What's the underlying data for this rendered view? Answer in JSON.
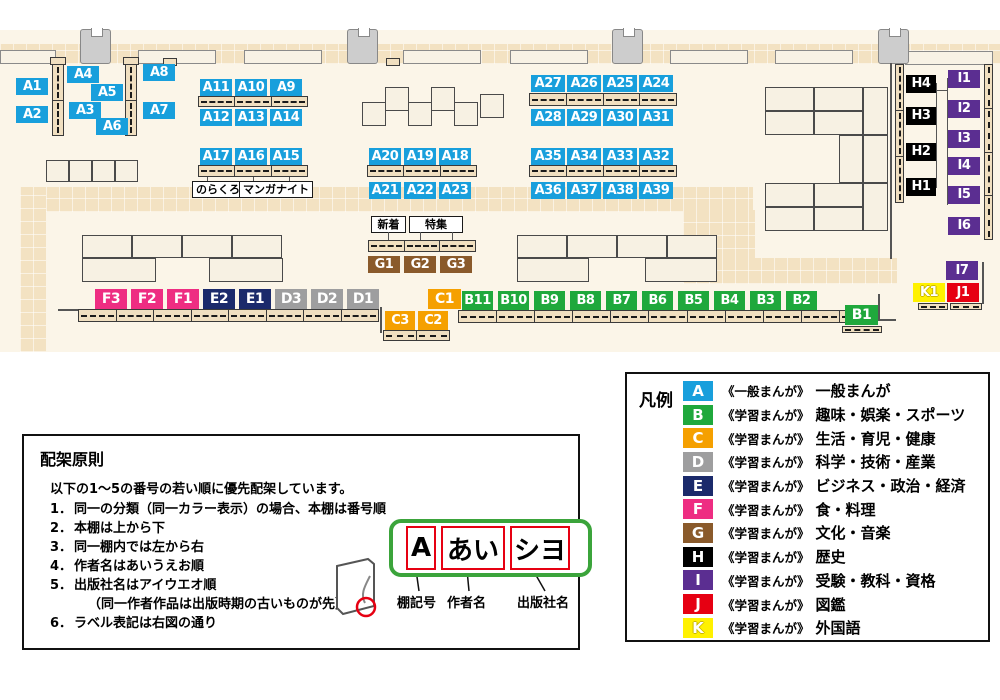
{
  "map": {
    "colors": {
      "A": "#189FDC",
      "B": "#1FA83C",
      "C": "#F5A000",
      "D": "#9E9E9F",
      "E": "#1B2A6B",
      "F": "#EE2D82",
      "G": "#8A5A2B",
      "H": "#000000",
      "I": "#5B2E91",
      "J": "#E60012",
      "K": "#FFF100"
    },
    "groups": {
      "a1": [
        {
          "t": "A1",
          "c": "A"
        }
      ],
      "a2": [
        {
          "t": "A2",
          "c": "A"
        }
      ],
      "a3": [
        {
          "t": "A3",
          "c": "A"
        }
      ],
      "a4": [
        {
          "t": "A4",
          "c": "A"
        }
      ],
      "a5": [
        {
          "t": "A5",
          "c": "A"
        }
      ],
      "a6": [
        {
          "t": "A6",
          "c": "A"
        }
      ],
      "a7": [
        {
          "t": "A7",
          "c": "A"
        }
      ],
      "a8": [
        {
          "t": "A8",
          "c": "A"
        }
      ],
      "row_a9": [
        {
          "t": "A11",
          "c": "A"
        },
        {
          "t": "A10",
          "c": "A"
        },
        {
          "t": "A9",
          "c": "A"
        }
      ],
      "row_a12": [
        {
          "t": "A12",
          "c": "A"
        },
        {
          "t": "A13",
          "c": "A"
        },
        {
          "t": "A14",
          "c": "A"
        }
      ],
      "row_a15": [
        {
          "t": "A17",
          "c": "A"
        },
        {
          "t": "A16",
          "c": "A"
        },
        {
          "t": "A15",
          "c": "A"
        }
      ],
      "row_a18": [
        {
          "t": "A20",
          "c": "A"
        },
        {
          "t": "A19",
          "c": "A"
        },
        {
          "t": "A18",
          "c": "A"
        }
      ],
      "row_a21": [
        {
          "t": "A21",
          "c": "A"
        },
        {
          "t": "A22",
          "c": "A"
        },
        {
          "t": "A23",
          "c": "A"
        }
      ],
      "row_a24": [
        {
          "t": "A27",
          "c": "A"
        },
        {
          "t": "A26",
          "c": "A"
        },
        {
          "t": "A25",
          "c": "A"
        },
        {
          "t": "A24",
          "c": "A"
        }
      ],
      "row_a28": [
        {
          "t": "A28",
          "c": "A"
        },
        {
          "t": "A29",
          "c": "A"
        },
        {
          "t": "A30",
          "c": "A"
        },
        {
          "t": "A31",
          "c": "A"
        }
      ],
      "row_a32": [
        {
          "t": "A35",
          "c": "A"
        },
        {
          "t": "A34",
          "c": "A"
        },
        {
          "t": "A33",
          "c": "A"
        },
        {
          "t": "A32",
          "c": "A"
        }
      ],
      "row_a36": [
        {
          "t": "A36",
          "c": "A"
        },
        {
          "t": "A37",
          "c": "A"
        },
        {
          "t": "A38",
          "c": "A"
        },
        {
          "t": "A39",
          "c": "A"
        }
      ],
      "row_g": [
        {
          "t": "G1",
          "c": "G"
        },
        {
          "t": "G2",
          "c": "G"
        },
        {
          "t": "G3",
          "c": "G"
        }
      ],
      "row_fed": [
        {
          "t": "F3",
          "c": "F"
        },
        {
          "t": "F2",
          "c": "F"
        },
        {
          "t": "F1",
          "c": "F"
        },
        {
          "t": "E2",
          "c": "E"
        },
        {
          "t": "E1",
          "c": "E"
        },
        {
          "t": "D3",
          "c": "D"
        },
        {
          "t": "D2",
          "c": "D"
        },
        {
          "t": "D1",
          "c": "D"
        }
      ],
      "c1": [
        {
          "t": "C1",
          "c": "C"
        }
      ],
      "row_c23": [
        {
          "t": "C3",
          "c": "C"
        },
        {
          "t": "C2",
          "c": "C"
        }
      ],
      "row_b": [
        {
          "t": "B11",
          "c": "B"
        },
        {
          "t": "B10",
          "c": "B"
        },
        {
          "t": "B9",
          "c": "B"
        },
        {
          "t": "B8",
          "c": "B"
        },
        {
          "t": "B7",
          "c": "B"
        },
        {
          "t": "B6",
          "c": "B"
        },
        {
          "t": "B5",
          "c": "B"
        },
        {
          "t": "B4",
          "c": "B"
        },
        {
          "t": "B3",
          "c": "B"
        },
        {
          "t": "B2",
          "c": "B"
        }
      ],
      "b1": [
        {
          "t": "B1",
          "c": "B"
        }
      ],
      "h4": [
        {
          "t": "H4",
          "c": "H"
        }
      ],
      "h3": [
        {
          "t": "H3",
          "c": "H"
        }
      ],
      "h2": [
        {
          "t": "H2",
          "c": "H"
        }
      ],
      "h1": [
        {
          "t": "H1",
          "c": "H"
        }
      ],
      "i1": [
        {
          "t": "I1",
          "c": "I"
        }
      ],
      "i2": [
        {
          "t": "I2",
          "c": "I"
        }
      ],
      "i3": [
        {
          "t": "I3",
          "c": "I"
        }
      ],
      "i4": [
        {
          "t": "I4",
          "c": "I"
        }
      ],
      "i5": [
        {
          "t": "I5",
          "c": "I"
        }
      ],
      "i6": [
        {
          "t": "I6",
          "c": "I"
        }
      ],
      "i7": [
        {
          "t": "I7",
          "c": "I"
        }
      ],
      "k1": [
        {
          "t": "K1",
          "c": "K"
        }
      ],
      "j1": [
        {
          "t": "J1",
          "c": "J"
        }
      ]
    }
  },
  "annotations": {
    "norakuro": "のらくろ",
    "manganight": "マンガナイト",
    "new_arrivals": "新着",
    "feature": "特集"
  },
  "legend": {
    "title": "凡例",
    "items": [
      {
        "key": "A",
        "tag": "《一般まんが》",
        "label": "一般まんが"
      },
      {
        "key": "B",
        "tag": "《学習まんが》",
        "label": "趣味・娯楽・スポーツ"
      },
      {
        "key": "C",
        "tag": "《学習まんが》",
        "label": "生活・育児・健康"
      },
      {
        "key": "D",
        "tag": "《学習まんが》",
        "label": "科学・技術・産業"
      },
      {
        "key": "E",
        "tag": "《学習まんが》",
        "label": "ビジネス・政治・経済"
      },
      {
        "key": "F",
        "tag": "《学習まんが》",
        "label": "食・料理"
      },
      {
        "key": "G",
        "tag": "《学習まんが》",
        "label": "文化・音楽"
      },
      {
        "key": "H",
        "tag": "《学習まんが》",
        "label": "歴史"
      },
      {
        "key": "I",
        "tag": "《学習まんが》",
        "label": "受験・教科・資格"
      },
      {
        "key": "J",
        "tag": "《学習まんが》",
        "label": "図鑑"
      },
      {
        "key": "K",
        "tag": "《学習まんが》",
        "label": "外国語"
      }
    ]
  },
  "principles": {
    "title": "配架原則",
    "intro": "以下の1～5の番号の若い順に優先配架しています。",
    "items": [
      {
        "no": "1．",
        "text": "同一の分類（同一カラー表示）の場合、本棚は番号順"
      },
      {
        "no": "2．",
        "text": "本棚は上から下"
      },
      {
        "no": "3．",
        "text": "同一棚内では左から右"
      },
      {
        "no": "4．",
        "text": "作者名はあいうえお順"
      },
      {
        "no": "5．",
        "text": "出版社名はアイウエオ順"
      },
      {
        "no": "",
        "text": "（同一作者作品は出版時期の古いものが先）"
      },
      {
        "no": "6．",
        "text": "ラベル表記は右図の通り"
      }
    ]
  },
  "diagram": {
    "segments": [
      {
        "text": "A",
        "caption": "棚記号"
      },
      {
        "text": "あい",
        "caption": "作者名"
      },
      {
        "text": "シヨ",
        "caption": "出版社名"
      }
    ]
  }
}
